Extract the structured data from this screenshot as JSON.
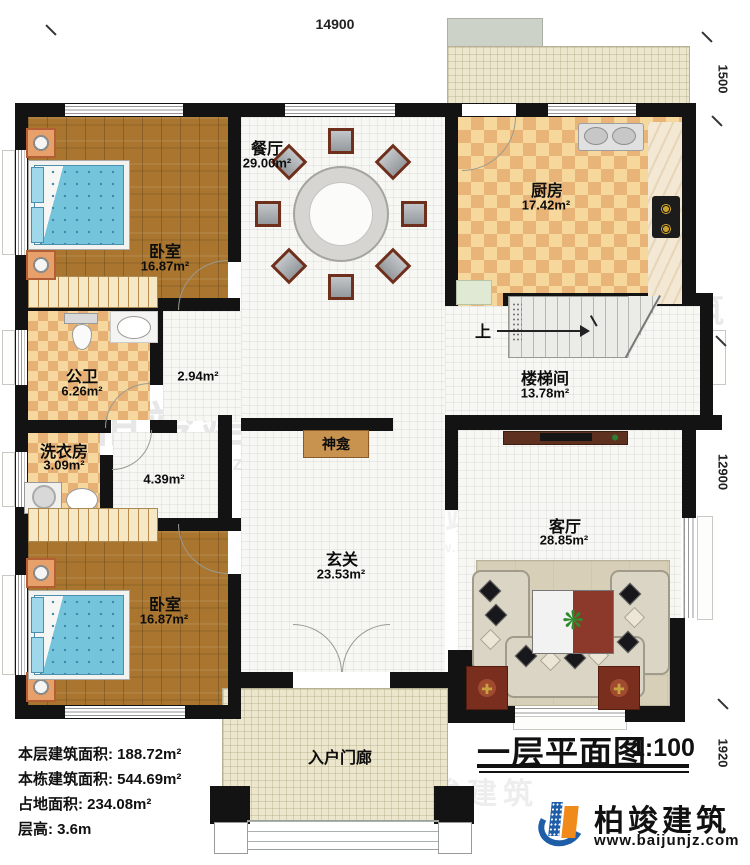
{
  "plan": {
    "sheet_title": "一层平面图",
    "sheet_scale": "1:100",
    "dims": {
      "top": "14900",
      "right_upper": "1500",
      "right_middle": "12900",
      "right_lower": "1920"
    },
    "rooms": [
      {
        "id": "bedroom-top",
        "name": "卧室",
        "area": "16.87m²"
      },
      {
        "id": "dining",
        "name": "餐厅",
        "area": "29.00m²"
      },
      {
        "id": "kitchen",
        "name": "厨房",
        "area": "17.42m²"
      },
      {
        "id": "bathroom",
        "name": "公卫",
        "area": "6.26m²"
      },
      {
        "id": "hall",
        "name": "",
        "area": "2.94m²"
      },
      {
        "id": "laundry",
        "name": "洗衣房",
        "area": "3.09m²"
      },
      {
        "id": "corridor",
        "name": "",
        "area": "4.39m²"
      },
      {
        "id": "stairwell",
        "name": "楼梯间",
        "area": "13.78m²"
      },
      {
        "id": "foyer",
        "name": "玄关",
        "area": "23.53m²"
      },
      {
        "id": "living",
        "name": "客厅",
        "area": "28.85m²"
      },
      {
        "id": "bedroom-bottom",
        "name": "卧室",
        "area": "16.87m²"
      },
      {
        "id": "porch",
        "name": "入户门廊",
        "area": ""
      }
    ],
    "labels": {
      "shrine": "神龛",
      "stairs_up": "上"
    },
    "info": [
      {
        "label": "本层建筑面积:",
        "value": "188.72m²"
      },
      {
        "label": "本栋建筑面积:",
        "value": "544.69m²"
      },
      {
        "label": "占地面积:",
        "value": "234.08m²"
      },
      {
        "label": "层高:",
        "value": "3.6m"
      }
    ],
    "logo": {
      "name": "柏竣建筑",
      "url": "www.baijunjz.com"
    },
    "watermark": {
      "text": "柏竣建筑",
      "url": "www.baijunjz.com"
    },
    "colors": {
      "wall": "#131313",
      "wood_floor": "#a9752f",
      "tile_light": "#f6d79c",
      "tile_dark": "#e9b478",
      "bed": "#74c4dc",
      "shrine_bg": "#c8924f",
      "logo_blue": "#1e5da8",
      "logo_orange": "#ef8a1b"
    }
  }
}
